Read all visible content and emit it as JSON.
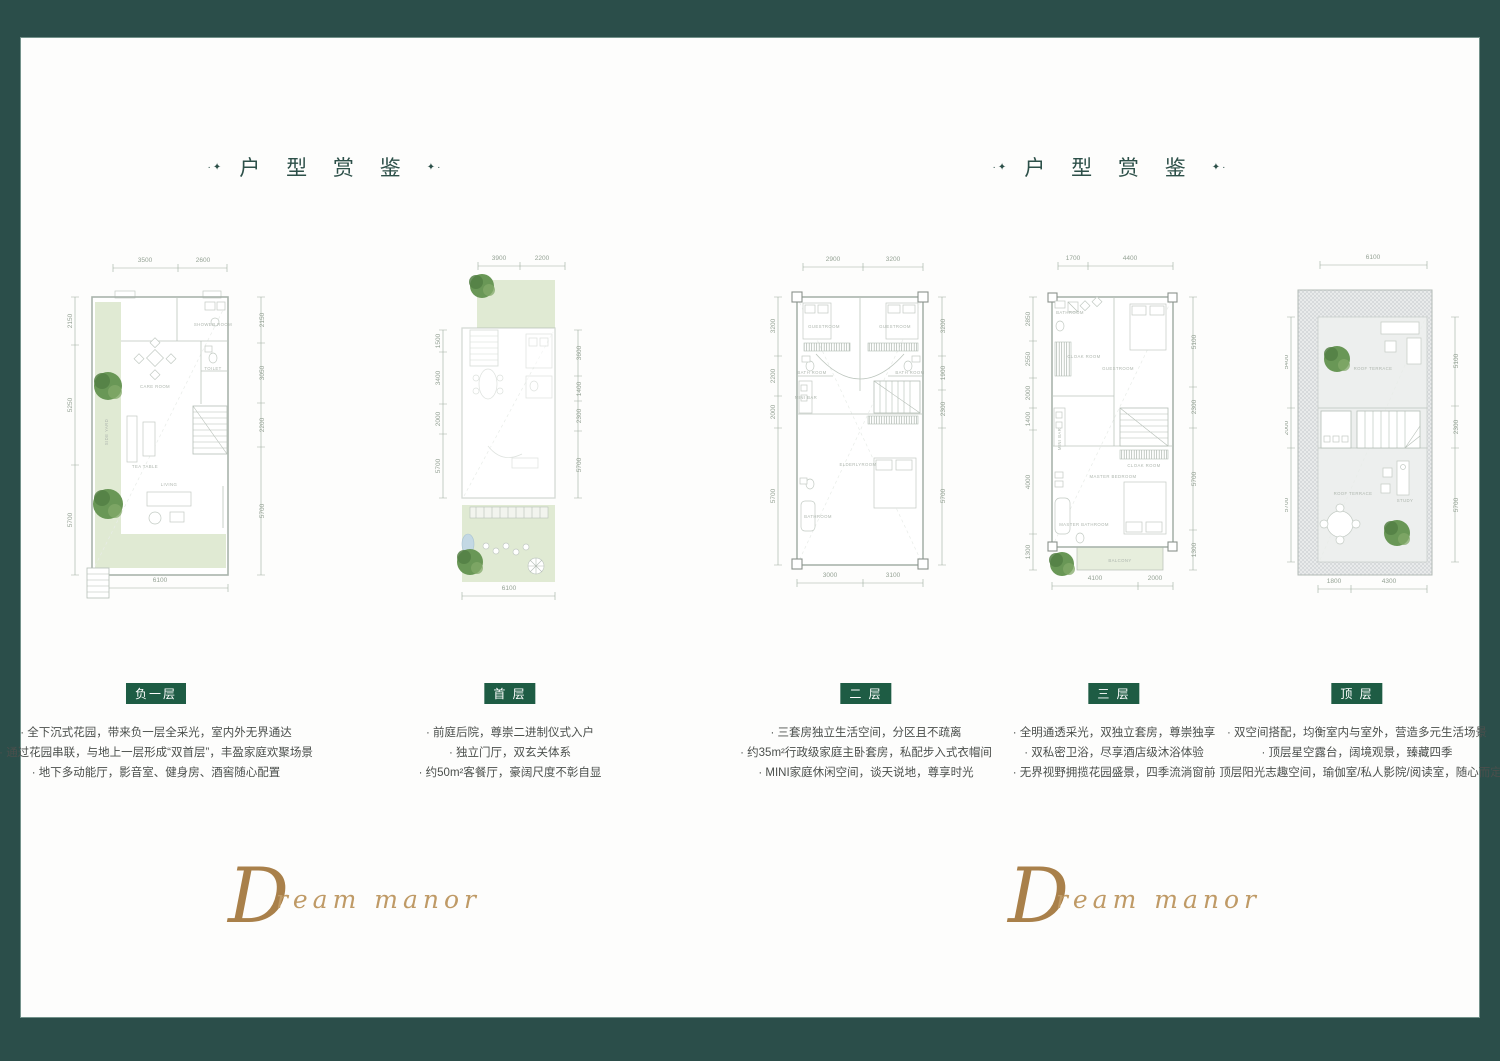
{
  "frame": {
    "color": "#2b4e4a"
  },
  "section": {
    "title": "户 型 赏 鉴",
    "ornament": "✦",
    "dot": "·"
  },
  "signature": {
    "initial": "D",
    "rest": "ream manor"
  },
  "plans": [
    {
      "badge": "负一层",
      "bullets": [
        "全下沉式花园，带来负一层全采光，室内外无界通达",
        "通过花园串联，与地上一层形成“双首层”，丰盈家庭欢聚场景",
        "地下多动能厅，影音室、健身房、酒窖随心配置"
      ],
      "dims": {
        "top": [
          "3500",
          "2600"
        ],
        "left": [
          "2150",
          "5250",
          "5700"
        ],
        "right": [
          "2150",
          "3050",
          "2200",
          "5700"
        ],
        "bottom": [
          "6100"
        ]
      },
      "rooms": {
        "shower": "SHOWER ROOM",
        "toilet": "TOILET",
        "care": "CARE ROOM",
        "side_yard": "SIDE YARD",
        "tea": "TEA TABLE",
        "living": "LIVING"
      }
    },
    {
      "badge": "首 层",
      "bullets": [
        "前庭后院，尊崇二进制仪式入户",
        "独立门厅，双玄关体系",
        "约50m²客餐厅，豪阔尺度不彰自显"
      ],
      "dims": {
        "top": [
          "3900",
          "2200"
        ],
        "left": [
          "1500",
          "3400",
          "2000",
          "5700"
        ],
        "right": [
          "3600",
          "1400",
          "2300",
          "5700"
        ],
        "bottom": [
          "6100"
        ]
      }
    },
    {
      "badge": "二 层",
      "bullets": [
        "三套房独立生活空间，分区且不疏离",
        "约35m²行政级家庭主卧套房，私配步入式衣帽间",
        "MINI家庭休闲空间，谈天说地，尊享时光"
      ],
      "dims": {
        "top": [
          "2900",
          "3200"
        ],
        "left": [
          "3200",
          "2200",
          "2000",
          "5700"
        ],
        "right": [
          "3200",
          "1900",
          "2300",
          "5700"
        ],
        "bottom": [
          "3000",
          "3100"
        ]
      },
      "rooms": {
        "guest1": "GUESTROOM",
        "guest2": "GUESTROOM",
        "bath1": "BATH ROOM",
        "bath2": "BATH ROOM",
        "minibar": "MINI BAR",
        "elderly": "ELDERLYROOM",
        "bathroom": "BATHROOM"
      }
    },
    {
      "badge": "三 层",
      "bullets": [
        "全明通透采光，双独立套房，尊崇独享",
        "双私密卫浴，尽享酒店级沐浴体验",
        "无界视野拥揽花园盛景，四季流淌窗前"
      ],
      "dims": {
        "top": [
          "1700",
          "4400"
        ],
        "left": [
          "2850",
          "2550",
          "2000",
          "1400",
          "4000",
          "1300"
        ],
        "right": [
          "5100",
          "2300",
          "5700",
          "1300"
        ],
        "bottom": [
          "4100",
          "2000"
        ]
      },
      "rooms": {
        "bathroom": "BATHROOM",
        "guest": "GUESTROOM",
        "cloak1": "CLOAK ROOM",
        "minibar": "MINI BAR",
        "cloak2": "CLOAK ROOM",
        "master": "MASTER BEDROOM",
        "masterbath": "MASTER BATHROOM",
        "balcony": "BALCONY"
      }
    },
    {
      "badge": "顶 层",
      "bullets": [
        "双空间搭配，均衡室内与室外，营造多元生活场景",
        "顶层星空露台，阔境观景，臻藏四季",
        "顶层阳光志趣空间，瑜伽室/私人影院/阅读室，随心而定"
      ],
      "dims": {
        "top": [
          "6100"
        ],
        "left": [
          "5400",
          "2000",
          "5700"
        ],
        "right": [
          "5100",
          "2300",
          "5700"
        ],
        "bottom": [
          "1800",
          "4300"
        ]
      },
      "rooms": {
        "terrace1": "ROOF TERRACE",
        "terrace2": "ROOF TERRACE",
        "study": "STUDY"
      }
    }
  ]
}
